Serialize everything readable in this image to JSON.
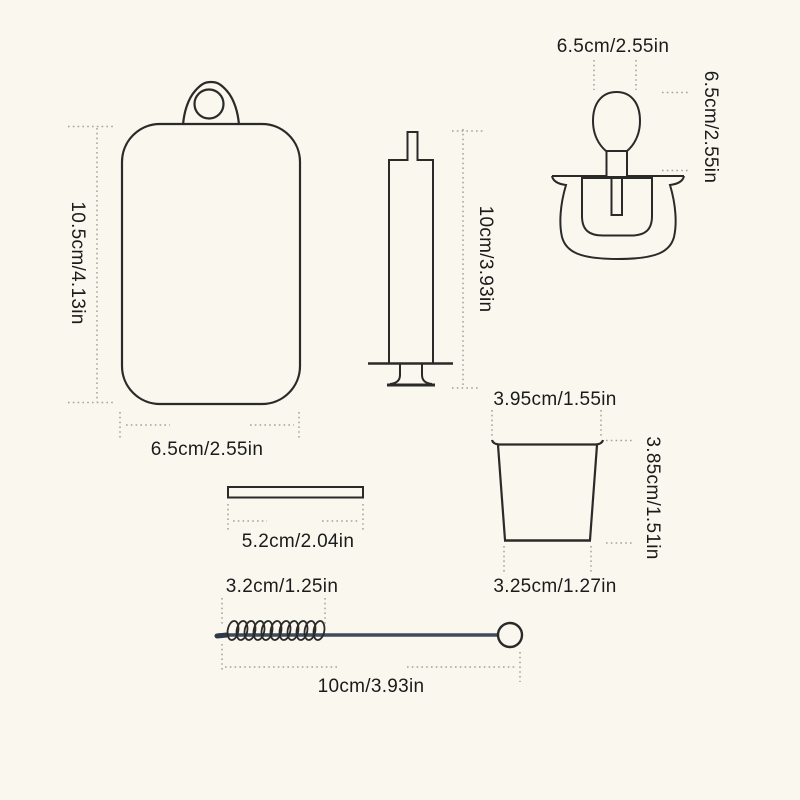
{
  "colors": {
    "background": "#f9f7ee",
    "outline": "#2a2a28",
    "rod_accent": "#3e4b5d",
    "dimension_line": "#a6a29a",
    "label_text": "#1b1b1b"
  },
  "items": {
    "cutting_board": {
      "height_label": "10.5cm/4.13in",
      "width_label": "6.5cm/2.55in"
    },
    "syringe": {
      "length_label": "10cm/3.93in"
    },
    "pacifier": {
      "width_label": "6.5cm/2.55in",
      "height_label": "6.5cm/2.55in"
    },
    "cup": {
      "top_diameter_label": "3.95cm/1.55in",
      "height_label": "3.85cm/1.51in",
      "bottom_diameter_label": "3.25cm/1.27in"
    },
    "flat_bar": {
      "length_label": "5.2cm/2.04in"
    },
    "cleaning_brush": {
      "head_length_label": "3.2cm/1.25in",
      "total_length_label": "10cm/3.93in"
    }
  }
}
